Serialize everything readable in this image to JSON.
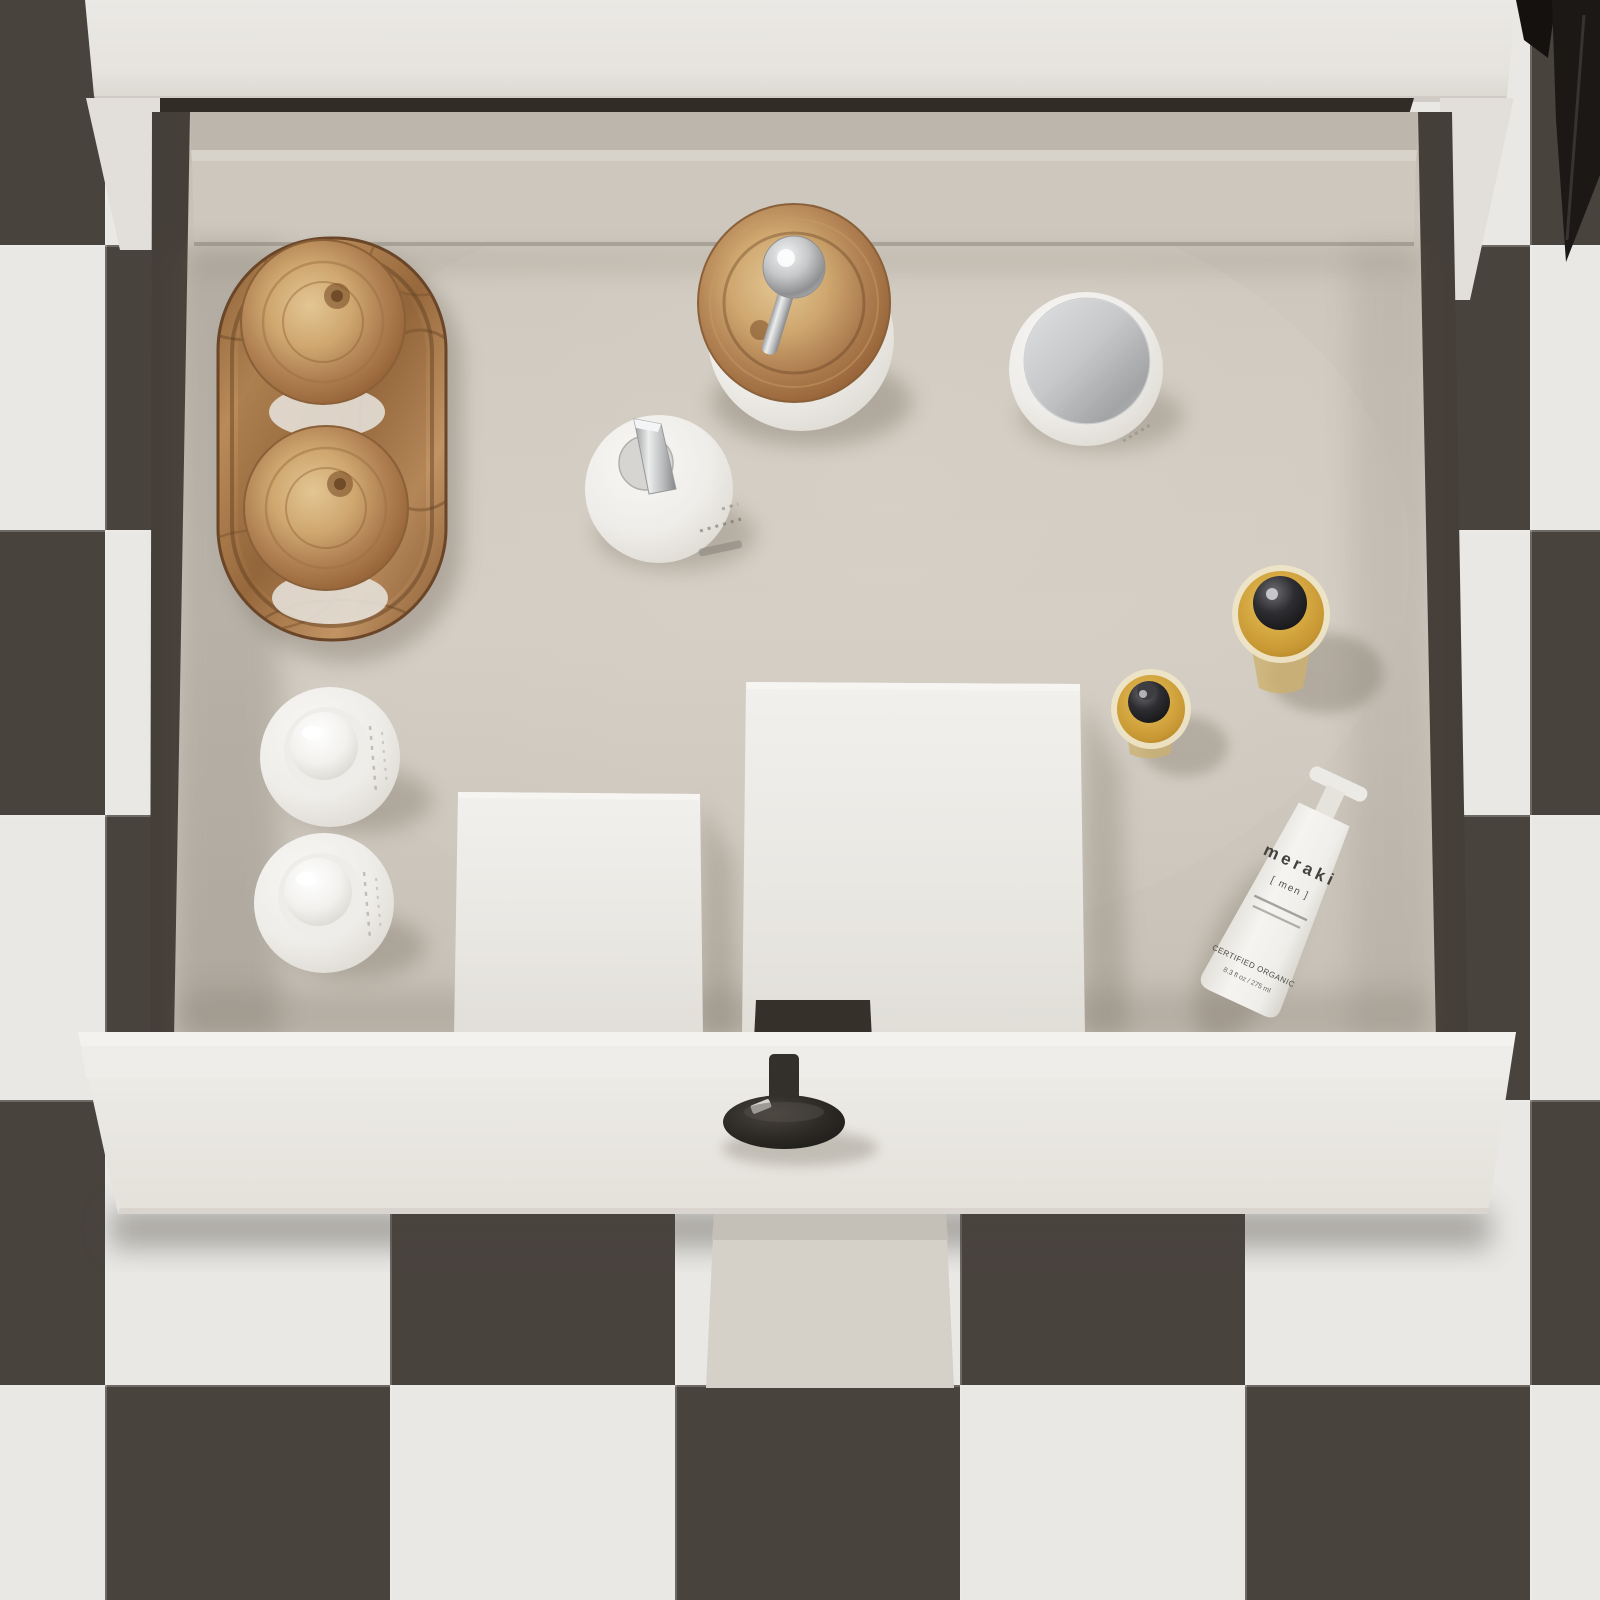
{
  "meta": {
    "title": "Top-down view of an open white bathroom vanity drawer with toiletries, on a checkerboard tile floor",
    "view": "overhead 3D render"
  },
  "palette": {
    "floor_tile_light": "#e9e8e5",
    "floor_tile_dark": "#49433e",
    "cabinet_white": "#eae8e4",
    "drawer_front_white": "#edebe7",
    "drawer_interior_greige": "#cbc5bb",
    "drawer_wall_dark": "#453f39",
    "burl_wood": "#b98b58",
    "amber_glass": "#d2a844",
    "chrome": "#c3c4c6",
    "knob_black": "#2b2824",
    "dark_object": "#1b1816"
  },
  "products": {
    "tube": {
      "brand": "meraki",
      "variant": "[ men ]",
      "certification": "CERTIFIED ORGANIC",
      "volume": "8.3 fl oz / 275 ml"
    },
    "items": [
      {
        "name": "burl-wood-tray",
        "description": "oval burl wood vanity tray"
      },
      {
        "name": "burl-lid-glass-jar-1",
        "description": "glass jar with round burl wood lid, on tray"
      },
      {
        "name": "burl-lid-glass-jar-2",
        "description": "glass jar with round burl wood lid, on tray"
      },
      {
        "name": "wood-lid-pump-dispenser",
        "description": "white dispenser with burl wood lid and chrome pump"
      },
      {
        "name": "white-pump-dispenser",
        "description": "white dispenser with angular chrome pump"
      },
      {
        "name": "cream-jar-chrome-lid",
        "description": "white cosmetic jar with chrome lid"
      },
      {
        "name": "amber-dropper-bottle-large",
        "description": "amber glass bottle with black cap"
      },
      {
        "name": "amber-dropper-bottle-small",
        "description": "amber glass dropper bottle with black cap"
      },
      {
        "name": "meraki-mens-tube",
        "description": "white meraki [men] tube, tilted"
      },
      {
        "name": "white-dome-bottle-1",
        "description": "white bottle with dome cap"
      },
      {
        "name": "white-dome-bottle-2",
        "description": "white bottle with dome cap"
      },
      {
        "name": "white-box-small",
        "description": "white carton standing in drawer"
      },
      {
        "name": "white-box-large",
        "description": "white carton standing in drawer"
      },
      {
        "name": "drawer-knob",
        "description": "black round drawer knob"
      }
    ]
  }
}
